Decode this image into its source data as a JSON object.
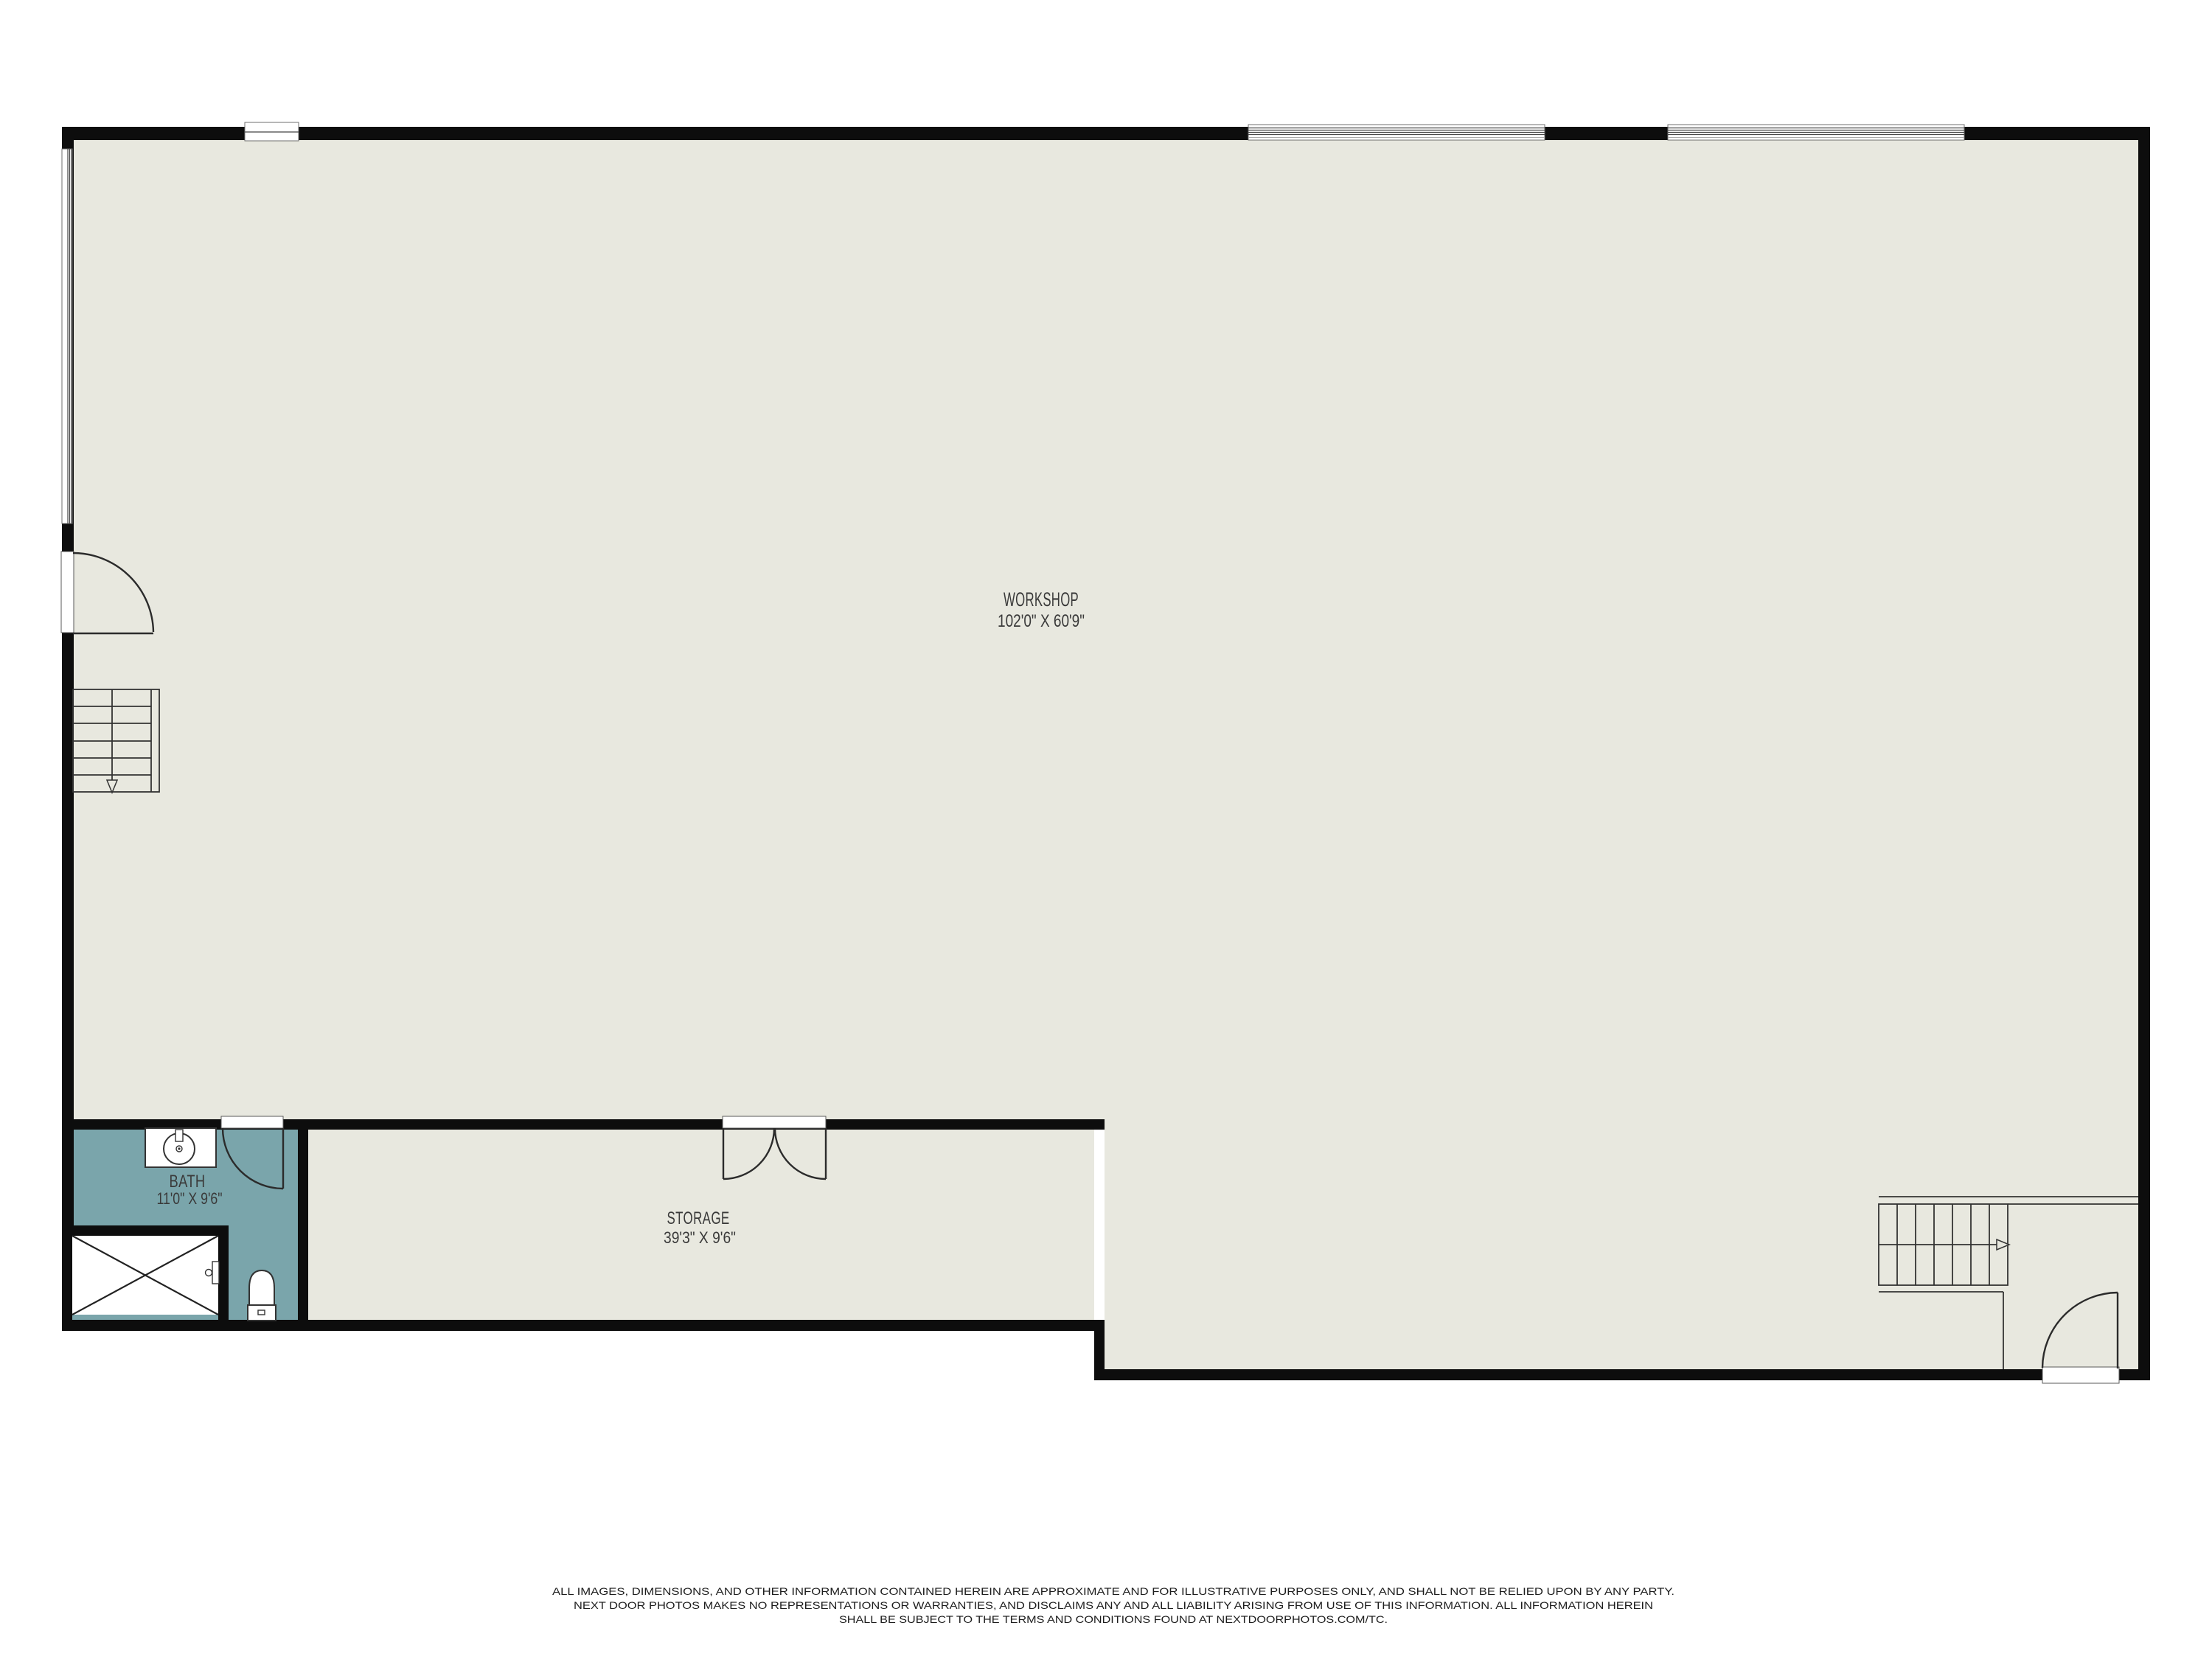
{
  "colors": {
    "wall": "#0d0d0d",
    "floor": "#e8e8df",
    "bath_floor": "#7aa5ab",
    "label": "#3a3a3a",
    "disclaimer": "#1d1d1d",
    "outside": "#ffffff"
  },
  "rooms": {
    "workshop": {
      "name": "WORKSHOP",
      "dimensions": "102'0\" X 60'9\""
    },
    "storage": {
      "name": "STORAGE",
      "dimensions": "39'3\" X 9'6\""
    },
    "bath": {
      "name": "BATH",
      "dimensions": "11'0\" X 9'6\""
    }
  },
  "fixtures": {
    "sink": "sink-icon",
    "toilet": "toilet-icon",
    "shower": "shower-icon",
    "stairs_left": "stairs-down-icon",
    "stairs_right": "stairs-up-icon"
  },
  "disclaimer": {
    "line1": "ALL IMAGES, DIMENSIONS, AND OTHER INFORMATION CONTAINED HEREIN ARE APPROXIMATE AND FOR ILLUSTRATIVE PURPOSES ONLY, AND SHALL NOT BE RELIED UPON BY ANY PARTY.",
    "line2": "NEXT DOOR PHOTOS MAKES NO REPRESENTATIONS OR WARRANTIES, AND DISCLAIMS ANY AND ALL LIABILITY ARISING FROM USE OF THIS INFORMATION. ALL INFORMATION HEREIN",
    "line3": "SHALL BE SUBJECT TO THE TERMS AND CONDITIONS FOUND AT NEXTDOORPHOTOS.COM/TC."
  }
}
